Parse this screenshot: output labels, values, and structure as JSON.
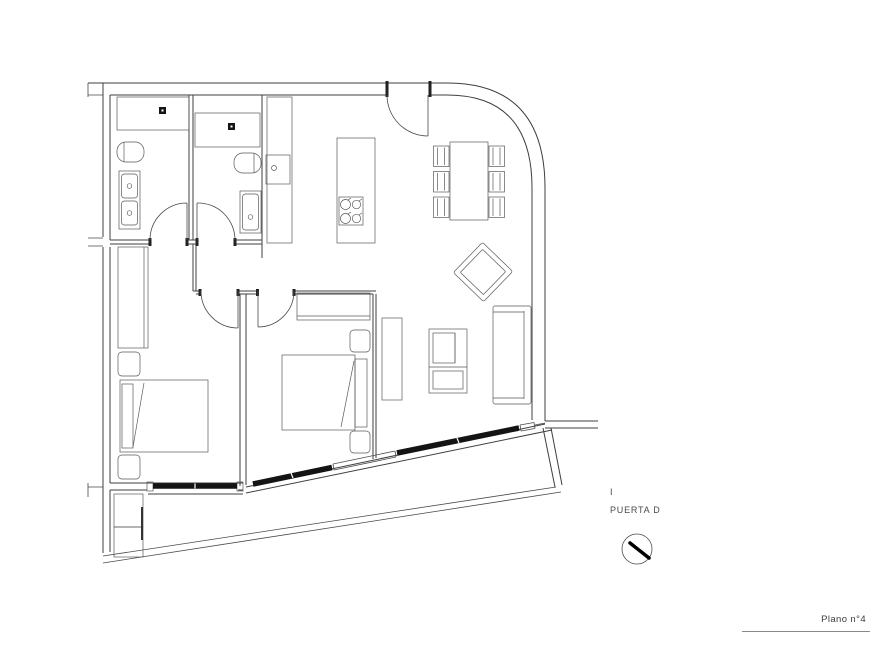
{
  "annotations": {
    "marker": "I",
    "door_label": "PUERTA D"
  },
  "titleblock": {
    "plan_number": "Plano n°4"
  },
  "icons": {
    "north_indicator": "circle-with-needle"
  },
  "colors": {
    "background": "#ffffff",
    "line": "#4a4a4a",
    "glazing_bar": "#141414",
    "text": "#4a4a4a"
  }
}
